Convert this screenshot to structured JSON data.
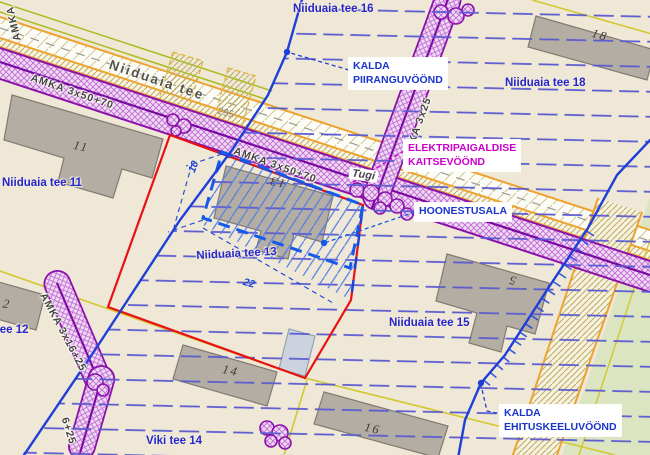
{
  "palette": {
    "background_beige": "#efe8d6",
    "boundary_red": "#e81212",
    "zone_blue": "#1f3fd9",
    "hatch_blue": "#5a5ad0",
    "building_area_blue": "#155ae8",
    "cable_purple": "#8a12aa",
    "annotation_magenta": "#cc00cc",
    "road_orange": "#eda32e",
    "parcel_yellow": "#d2c832",
    "building_gray": "#b4ada3",
    "greenery_green": "#dce5c2"
  },
  "road": {
    "name": "Niiduaia tee",
    "station": "295"
  },
  "streets": {
    "n11": "Niiduaia tee 11",
    "n12": "Niiduaia tee 12",
    "n13": "Niiduaia tee 13",
    "n15": "Niiduaia tee 15",
    "n16": "Niiduaia tee 16",
    "n18": "Niiduaia tee 18",
    "viki14": "Viki tee 14"
  },
  "buildings": {
    "b5": "5",
    "b11": "11",
    "b12": "12",
    "b13": "13",
    "b14": "14",
    "b16": "16",
    "b18": "18"
  },
  "cables": {
    "main_a": "AMKA 3x50+70",
    "main_b": "AMKA 3x50+70",
    "corner": "AMKA",
    "north_branch": "AMKA 3x25",
    "sw_branch": "AMKA 3x16+25",
    "sw_branch_tail": "6+25"
  },
  "pole": {
    "label": "Tugi"
  },
  "dimensions": {
    "depth": "10",
    "width": "22"
  },
  "annotations": {
    "piirang": {
      "line1": "KALDA",
      "line2": "PIIRANGUVÖÖND"
    },
    "kaitse": {
      "line1": "ELEKTRIPAIGALDISE",
      "line2": "KAITSEVÖÖND"
    },
    "hoonestusala": {
      "label": "HOONESTUSALA"
    },
    "keelu": {
      "line1": "KALDA",
      "line2": "EHITUSKEELUVÖÖND"
    }
  }
}
